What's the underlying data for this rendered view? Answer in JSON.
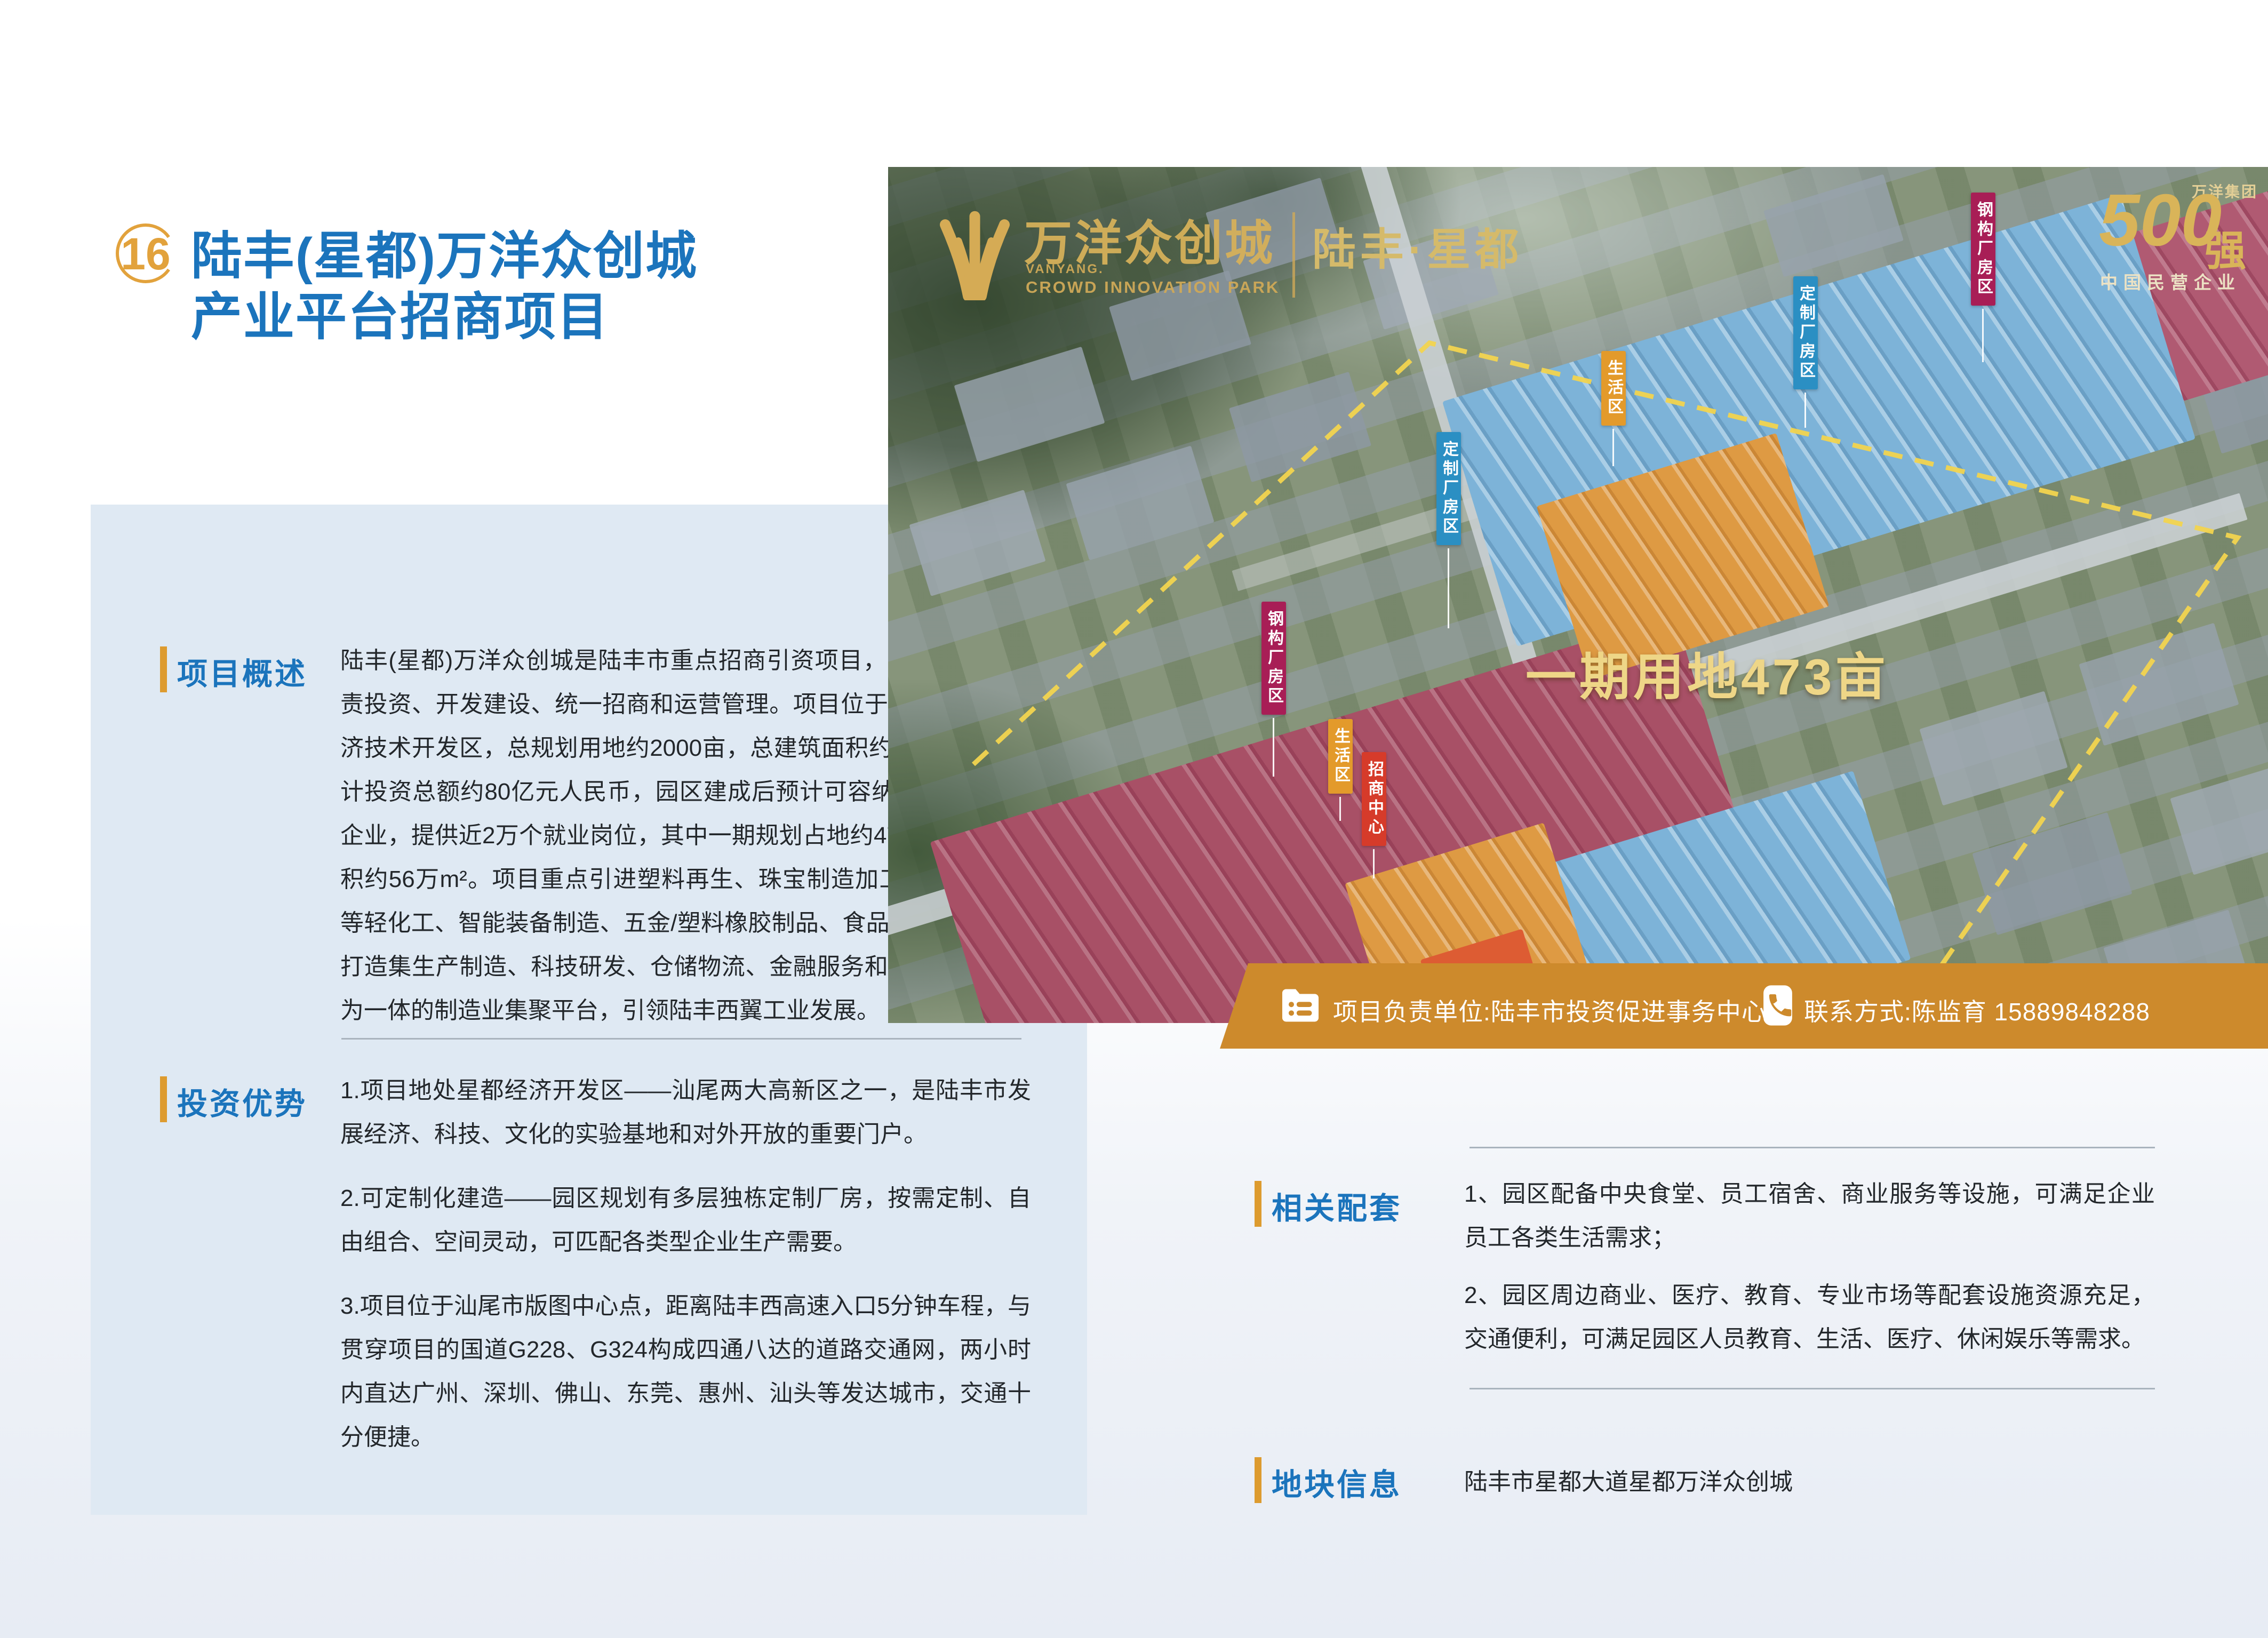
{
  "page": {
    "number": "16",
    "title_line1": "陆丰(星都)万洋众创城",
    "title_line2": "产业平台招商项目"
  },
  "overview": {
    "heading": "项目概述",
    "body": "陆丰(星都)万洋众创城是陆丰市重点招商引资项目，由万洋集团负责投资、开发建设、统一招商和运营管理。项目位于陆丰市星都经济技术开发区，总规划用地约2000亩，总建筑面积约210万m²，预计投资总额约80亿元人民币，园区建成后预计可容纳约600家中小企业，提供近2万个就业岗位，其中一期规划占地约473亩，建筑面积约56万m²。项目重点引进塑料再生、珠宝制造加工、油墨\\涂料等轻化工、智能装备制造、五金/塑料橡胶制品、食品药品等产业，打造集生产制造、科技研发、仓储物流、金融服务和智慧园区管理为一体的制造业集聚平台，引领陆丰西翼工业发展。"
  },
  "advantages": {
    "heading": "投资优势",
    "item1": "1.项目地处星都经济开发区——汕尾两大高新区之一，是陆丰市发展经济、科技、文化的实验基地和对外开放的重要门户。",
    "item2": "2.可定制化建造——园区规划有多层独栋定制厂房，按需定制、自由组合、空间灵动，可匹配各类型企业生产需要。",
    "item3": "3.项目位于汕尾市版图中心点，距离陆丰西高速入口5分钟车程，与贯穿项目的国道G228、G324构成四通八达的道路交通网，两小时内直达广州、深圳、佛山、东莞、惠州、汕头等发达城市，交通十分便捷。"
  },
  "facilities": {
    "heading": "相关配套",
    "item1": "1、园区配备中央食堂、员工宿舍、商业服务等设施，可满足企业员工各类生活需求；",
    "item2": "2、园区周边商业、医疗、教育、专业市场等配套设施资源充足，交通便利，可满足园区人员教育、生活、医疗、休闲娱乐等需求。"
  },
  "plot": {
    "heading": "地块信息",
    "body": "陆丰市星都大道星都万洋众创城"
  },
  "aerial": {
    "logo_cn": "万洋众创城",
    "logo_en1": "VANYANG.",
    "logo_en2": "CROWD INNOVATION PARK",
    "brand_location": "陆丰·星都",
    "badge_group": "万洋集团",
    "badge_number": "500",
    "badge_strong": "强",
    "badge_caption": "中国民营企业",
    "phase_area_text": "一期用地473亩",
    "labels": [
      {
        "text": "钢构厂房区",
        "color": "#a81e56"
      },
      {
        "text": "定制厂房区",
        "color": "#2b8fc3"
      },
      {
        "text": "生活区",
        "color": "#e39a2b"
      },
      {
        "text": "定制厂房区",
        "color": "#2b8fc3"
      },
      {
        "text": "钢构厂房区",
        "color": "#a81e56"
      },
      {
        "text": "生活区",
        "color": "#e39a2b"
      },
      {
        "text": "招商中心",
        "color": "#d63b2a"
      }
    ]
  },
  "contact": {
    "unit": "项目负责单位:陆丰市投资促进事务中心",
    "phone": "联系方式:陈监育 15889848288"
  },
  "colors": {
    "accent_orange": "#dd9b2f",
    "heading_blue": "#1b74bc",
    "contact_bar_orange": "#cd8a2c",
    "panel_blue": "#dfe9f3",
    "gold_text": "#eed687",
    "zone_blue": "#7db3d8",
    "zone_crimson": "#a85066",
    "zone_orange": "#de9a43"
  }
}
